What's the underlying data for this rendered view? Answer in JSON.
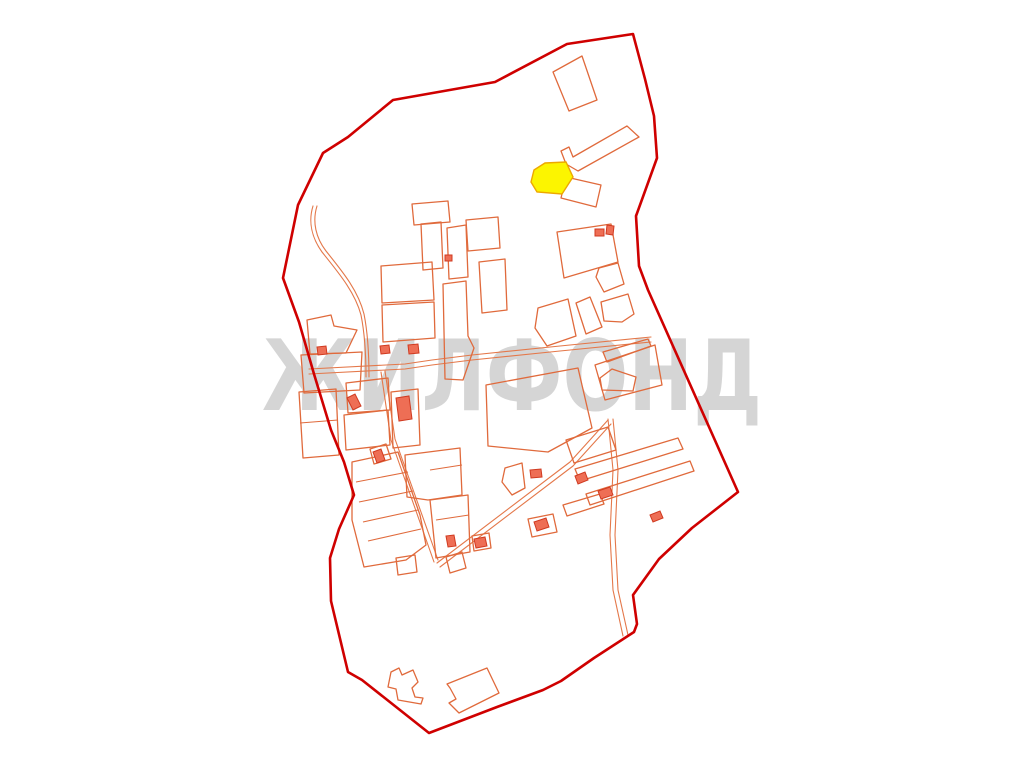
{
  "watermark": {
    "text": "ЖИЛФОНД"
  },
  "colors": {
    "page-bg": "#ffffff",
    "watermark": "#cbcbcb",
    "boundary": "#cf0000",
    "parcel": "#e06a3c",
    "road": "#e4784a",
    "building-fill": "#ee6e55",
    "building-stroke": "#d03a20",
    "highlight-fill": "#fcf500",
    "highlight-stroke": "#eda800"
  },
  "map": {
    "boundary": "M633,34 L567,44 L495,82 L393,100 L348,137 L323,153 L298,205 L283,278 L299,322 L314,374 L331,430 L344,462 L354,495 L339,529 L330,558 L331,601 L348,672 L362,680 L429,733 L497,707 L543,690 L561,681 L594,658 L634,632 L637,624 L633,595 L659,559 L692,528 L738,492 L648,290 L639,266 L636,216 L657,158 L654,116 L645,79 Z",
    "highlight": "M534,170 L545,163 L566,162 L573,177 L562,194 L537,192 L531,182 Z",
    "roads": [
      "M313,206 C308,222 312,238 322,252 C338,272 355,292 361,315 C365,335 366,355 366,377",
      "M317,206 C312,222 316,238 326,251 C342,271 358,290 364,314 C368,334 369,355 369,377",
      "M309,369 L405,364 L432,360 L472,355 L560,346 L651,337",
      "M309,374 L405,369 L432,365 L472,360 L560,351 L651,342",
      "M381,372 L391,440 L428,545 L434,562",
      "M385,371 L395,439 L432,543 L438,560",
      "M437,563 L570,462 L608,420",
      "M440,567 L573,466 L611,424",
      "M608,419 L613,470 L610,535 L613,590 L623,636",
      "M613,419 L618,470 L615,535 L618,590 L628,635"
    ],
    "parcels": [
      "M553,72 L582,56 L597,100 L569,111 Z",
      "M627,126 L639,137 L578,171 L566,164 L561,151 L569,147 L573,157 Z",
      "M566,177 L601,185 L596,207 L561,198 Z",
      "M557,232 L611,224 L618,262 L564,278 Z",
      "M599,268 L618,263 L624,284 L604,292 L596,277 Z",
      "M538,308 L568,299 L576,336 L547,346 L535,328 Z",
      "M576,303 L590,297 L602,327 L586,334 Z",
      "M601,302 L628,294 L634,314 L622,322 L604,321 Z",
      "M307,320 L331,315 L334,326 L357,330 L346,353 L310,354 Z",
      "M301,355 L362,352 L360,390 L304,393 Z",
      "M381,266 L432,262 L434,300 L382,303 Z",
      "M382,305 L434,302 L435,338 L383,342 Z",
      "M443,284 L466,281 L468,336 L474,348 L463,380 L445,379 Z",
      "M479,262 L505,259 L507,310 L482,313 Z",
      "M486,385 L578,368 L592,428 L548,452 L488,446 Z",
      "M595,365 L655,345 L662,385 L605,400 Z",
      "M603,352 L648,339 L651,346 L607,362 Z",
      "M600,378 L612,369 L636,377 L633,391 L602,390 Z",
      "M421,224 L441,222 L443,268 L423,270 Z",
      "M412,204 L448,201 L450,222 L414,225 Z",
      "M466,220 L498,217 L500,248 L468,251 Z",
      "M447,228 L466,225 L468,277 L449,279 Z",
      "M299,392 L336,389 L339,455 L303,458 Z",
      "M344,415 L388,410 L390,445 L346,450 Z",
      "M391,392 L418,389 L420,445 L393,448 Z",
      "M346,383 L388,378 L390,410 L348,413 Z",
      "M405,455 L460,448 L462,495 L428,500 L407,497 Z",
      "M430,500 L468,495 L470,552 L436,558 Z",
      "M352,462 L398,452 L420,515 L426,545 L406,560 L364,567 L352,520 Z",
      "M396,558 L415,555 L417,572 L398,575 Z",
      "M446,557 L462,552 L466,568 L450,573 Z",
      "M566,440 L608,427 L616,450 L574,463 Z",
      "M575,469 L678,438 L683,449 L580,481 Z",
      "M586,494 L690,461 L694,471 L590,505 Z",
      "M563,505 L600,494 L604,504 L567,516 Z",
      "M528,519 L553,514 L557,532 L532,537 Z",
      "M472,536 L489,533 L491,548 L474,551 Z",
      "M370,449 L386,444 L391,459 L374,464 Z",
      "M505,468 L522,463 L525,488 L512,495 L502,482 Z",
      "M391,672 L399,668 L402,675 L413,670 L418,682 L412,688 L415,697 L423,698 L421,704 L398,700 L396,689 L388,687 Z",
      "M447,684 L487,668 L499,693 L459,713 L449,703 L456,699 L450,688 Z"
    ],
    "dividers": [
      "M300,423 L338,420",
      "M356,482 L408,472",
      "M359,502 L413,491",
      "M363,522 L418,510",
      "M368,541 L421,529",
      "M430,470 L462,465",
      "M436,520 L469,515"
    ],
    "buildings": [
      "M595,229 L604,229 L604,236 L595,236 Z",
      "M607,225 L614,226 L613,235 L606,234 Z",
      "M445,255 L452,255 L452,261 L445,261 Z",
      "M380,346 L389,345 L390,353 L381,354 Z",
      "M408,345 L418,344 L419,353 L409,354 Z",
      "M317,347 L326,346 L327,354 L318,355 Z",
      "M347,398 L355,394 L361,406 L353,410 Z",
      "M396,398 L409,396 L412,419 L399,421 Z",
      "M373,452 L381,449 L385,460 L377,463 Z",
      "M530,470 L541,469 L542,477 L531,478 Z",
      "M575,476 L585,472 L588,480 L578,484 Z",
      "M598,491 L610,487 L613,495 L601,499 Z",
      "M650,515 L660,511 L663,518 L653,522 Z",
      "M534,522 L546,518 L549,527 L537,531 Z",
      "M474,539 L485,537 L487,546 L476,548 Z",
      "M446,536 L454,535 L456,546 L448,547 Z"
    ],
    "watermark_layout": {
      "x": 262,
      "y": 410,
      "font_size": 98,
      "text_length": 500
    }
  }
}
